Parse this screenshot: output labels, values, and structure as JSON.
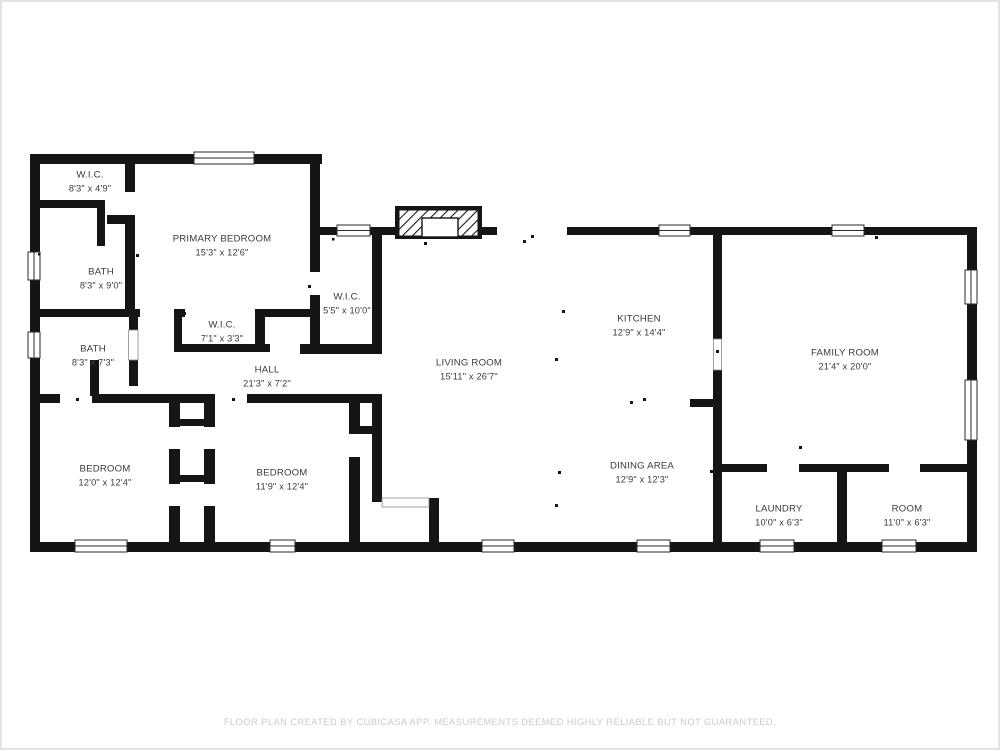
{
  "page": {
    "background": "#ffffff",
    "border_color": "#e3e3e3",
    "wall_color": "#151515",
    "label_color": "#3a3a3a"
  },
  "footer": {
    "text": "FLOOR PLAN CREATED BY CUBICASA APP. MEASUREMENTS DEEMED HIGHLY RELIABLE BUT NOT GUARANTEED."
  },
  "rooms": [
    {
      "name": "W.I.C.",
      "dimensions": "8'3\" x 4'9\""
    },
    {
      "name": "PRIMARY BEDROOM",
      "dimensions": "15'3\" x 12'6\""
    },
    {
      "name": "BATH",
      "dimensions": "8'3\" x 9'0\""
    },
    {
      "name": "BATH",
      "dimensions": "8'3\" x 7'3\""
    },
    {
      "name": "W.I.C.",
      "dimensions": "7'1\" x 3'3\""
    },
    {
      "name": "W.I.C.",
      "dimensions": "5'5\" x 10'0\""
    },
    {
      "name": "HALL",
      "dimensions": "21'3\" x 7'2\""
    },
    {
      "name": "BEDROOM",
      "dimensions": "12'0\" x 12'4\""
    },
    {
      "name": "BEDROOM",
      "dimensions": "11'9\" x 12'4\""
    },
    {
      "name": "LIVING ROOM",
      "dimensions": "15'11\" x 26'7\""
    },
    {
      "name": "KITCHEN",
      "dimensions": "12'9\" x 14'4\""
    },
    {
      "name": "DINING AREA",
      "dimensions": "12'9\" x 12'3\""
    },
    {
      "name": "FAMILY ROOM",
      "dimensions": "21'4\" x 20'0\""
    },
    {
      "name": "LAUNDRY",
      "dimensions": "10'0\" x 6'3\""
    },
    {
      "name": "ROOM",
      "dimensions": "11'0\" x 6'3\""
    }
  ]
}
